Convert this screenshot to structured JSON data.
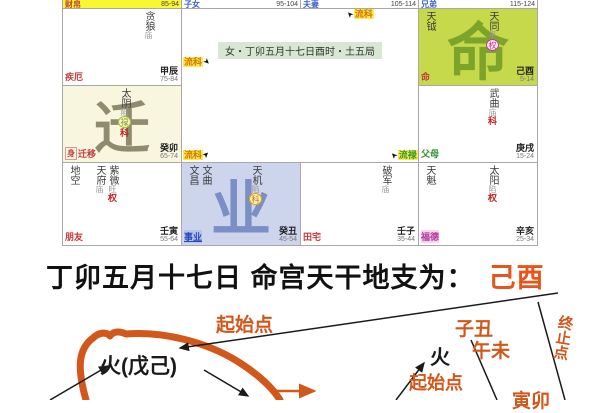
{
  "colors": {
    "accent_orange": "#d2571a",
    "caption_highlight": "#e8551a",
    "grid_line": "#a8a8a8",
    "ming_cell_bg": "#c5d94a",
    "ming_watermark": "#7ca32a",
    "qian_cell_bg": "#f9f6e0",
    "qian_watermark": "#8e8b6e",
    "ye_cell_bg": "#cdd5ec",
    "ye_watermark": "#7b8ec5",
    "flow_tag_bg": "#ffe94d",
    "flow_ke": "#d07800",
    "flow_lu": "#2e9a2e",
    "sliver_highlight_bg": "#f8f830"
  },
  "chart": {
    "info": "女・丁卯五月十七日酉时・土五局",
    "flow": {
      "top_right": "流科",
      "mid_left": "流科",
      "bottom_left": "流科",
      "bottom_right": "流禄"
    },
    "cursor_glyph": "➤",
    "palaces": {
      "S1": {
        "name": "财帛",
        "ages": "85-94",
        "name_style": "color:#c43b3b"
      },
      "S2": {
        "name": "子女",
        "ages": "95-104",
        "name_style": "color:#3a5fc8"
      },
      "S3": {
        "name": "夫妻",
        "ages": "105-114",
        "name_style": "color:#3a5fc8"
      },
      "S4": {
        "name": "兄弟",
        "ages": "115-124",
        "name_style": "color:#3a5fc8"
      },
      "A1": {
        "name": "疾厄",
        "stem": "甲辰",
        "ages": "75-84",
        "name_style": "color:#c43b3b",
        "stars_right": [
          {
            "name": "贪狼",
            "bright": "庙"
          }
        ]
      },
      "A4": {
        "name": "命",
        "stem": "己酉",
        "ages": "5-14",
        "name_style": "color:#c43b3b",
        "watermark": "命",
        "stars_left": [
          {
            "name": "天钺"
          }
        ],
        "stars_right": [
          {
            "name": "天同",
            "bright": "平",
            "circled": "权"
          }
        ]
      },
      "B1": {
        "name": "迁移",
        "body": "身",
        "stem": "癸卯",
        "ages": "65-74",
        "name_style": "color:#c43b3b",
        "watermark": "迁",
        "stars_right": [
          {
            "name": "太阴",
            "bright": "陷",
            "circled": "禄",
            "flow": "科"
          }
        ]
      },
      "B4": {
        "name": "父母",
        "stem": "庚戌",
        "ages": "15-24",
        "name_style": "color:#2e8b2e",
        "stars_right": [
          {
            "name": "武曲",
            "bright": "庙",
            "flow": "科"
          }
        ]
      },
      "C1": {
        "name": "朋友",
        "stem": "壬寅",
        "ages": "55-64",
        "name_style": "color:#c43b3b",
        "stars_left": [
          {
            "name": "地空"
          }
        ],
        "stars_right": [
          {
            "name": "天府",
            "bright": "庙"
          },
          {
            "name": "紫微",
            "bright": "旺",
            "flow": "权"
          }
        ]
      },
      "C2": {
        "name": "事业",
        "stem": "癸丑",
        "ages": "45-54",
        "name_style": "color:#2848c0;background:#b9c3e6;text-decoration:underline",
        "watermark": "业",
        "stars_left": [
          {
            "name": "文昌"
          },
          {
            "name": "文曲"
          }
        ],
        "stars_right": [
          {
            "name": "天机",
            "bright": "陷",
            "circled": "科"
          }
        ]
      },
      "C3": {
        "name": "田宅",
        "stem": "壬子",
        "ages": "35-44",
        "name_style": "color:#c43b3b",
        "stars_right": [
          {
            "name": "破军",
            "bright": "庙"
          }
        ]
      },
      "C4": {
        "name": "福德",
        "stem": "辛亥",
        "ages": "25-34",
        "name_style": "color:#b43a9e;background:#f4d6ee",
        "stars_left": [
          {
            "name": "天魁"
          }
        ],
        "stars_right": [
          {
            "name": "太阳",
            "bright": "陷",
            "flow": "权"
          }
        ]
      }
    }
  },
  "caption": {
    "text": "丁卯五月十七日  命宫天干地支为：",
    "highlight": "己酉"
  },
  "diagram": {
    "start_label_1": "起始点",
    "fire_main": "火(戊己)",
    "fire_2": "火",
    "start_label_2": "起始点",
    "zichou": "子丑",
    "wuwei": "午未",
    "end_label": "终止点",
    "yinmao": "寅卯"
  }
}
